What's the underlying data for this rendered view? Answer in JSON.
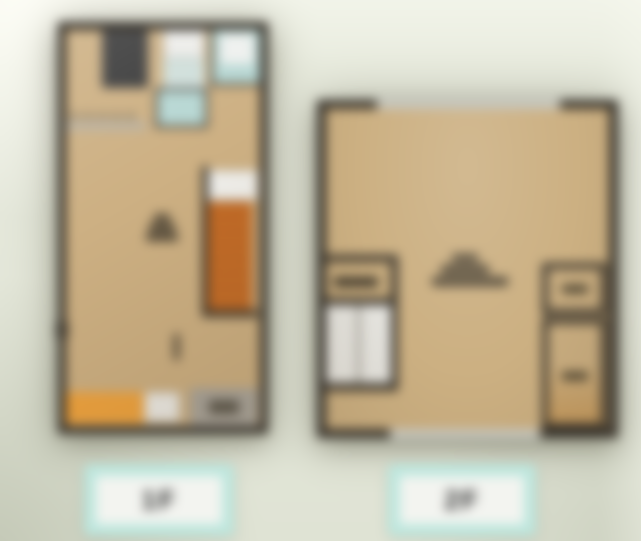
{
  "scene": {
    "type": "3d-floor-plan-viewer",
    "background_color": "#e5e8db",
    "wall_color": "#39342c",
    "floor_color": "#cdb083"
  },
  "floor_plans": [
    {
      "id": "first-floor",
      "features": [
        "dark-kitchen-block",
        "washer-unit",
        "utility-area",
        "bathroom",
        "bathtub-room",
        "kitchen-counter-line",
        "room-label",
        "window-box",
        "staircase-orange",
        "door-knob",
        "counter-yellow",
        "sink-white",
        "entrance-gray",
        "entrance-mat"
      ]
    },
    {
      "id": "second-floor",
      "features": [
        "window-top",
        "room-label",
        "stair-closet",
        "staircase-white",
        "closet-upper",
        "closet-lower",
        "window-bottom"
      ]
    }
  ],
  "floor_selector": {
    "buttons": [
      {
        "id": "floor-1",
        "label": "1F"
      },
      {
        "id": "floor-2",
        "label": "2F"
      }
    ],
    "button_color": "#bde7de",
    "button_inner_color": "#f3f4f0",
    "label_color": "#2d2d2d"
  },
  "palette": {
    "stairs_orange": "#c76d27",
    "counter_yellow": "#f1a43e",
    "bath_blue": "#b7d7d3",
    "dark_block": "#3c3c3c",
    "entry_gray": "#a9a59d",
    "window_gray": "#c6c6be"
  }
}
